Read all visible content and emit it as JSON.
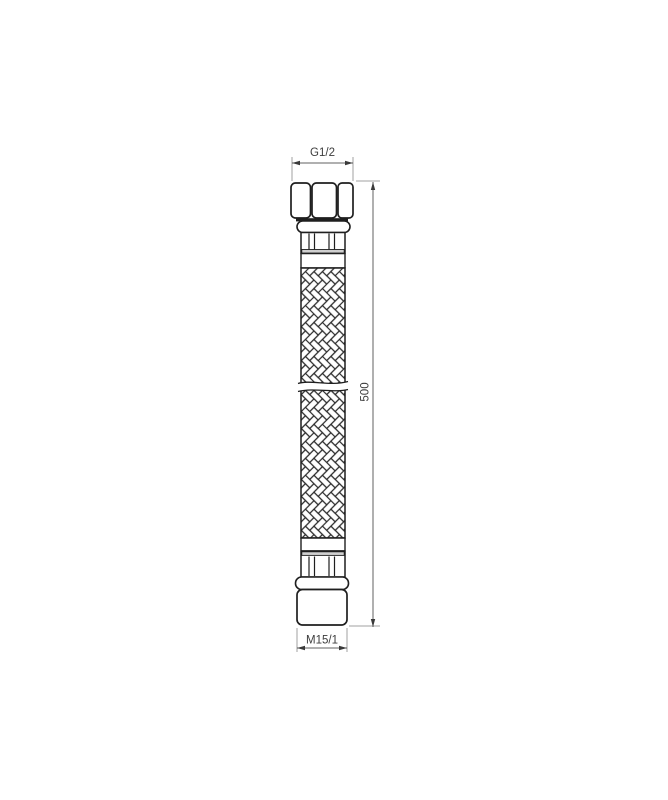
{
  "drawing": {
    "kind": "flexible-braided-hose-technical-drawing",
    "dim_top": {
      "label": "G1/2"
    },
    "dim_bottom": {
      "label": "M15/1"
    },
    "dim_length": {
      "label": "500"
    },
    "colors": {
      "background": "#ffffff",
      "outline": "#1f1f1f",
      "braid_stroke": "#2a2a2a",
      "dimension_line": "#606060",
      "extension_line": "#a0a0a0",
      "dimension_text": "#3d3d3d",
      "shading": "#cfcfcf"
    }
  }
}
